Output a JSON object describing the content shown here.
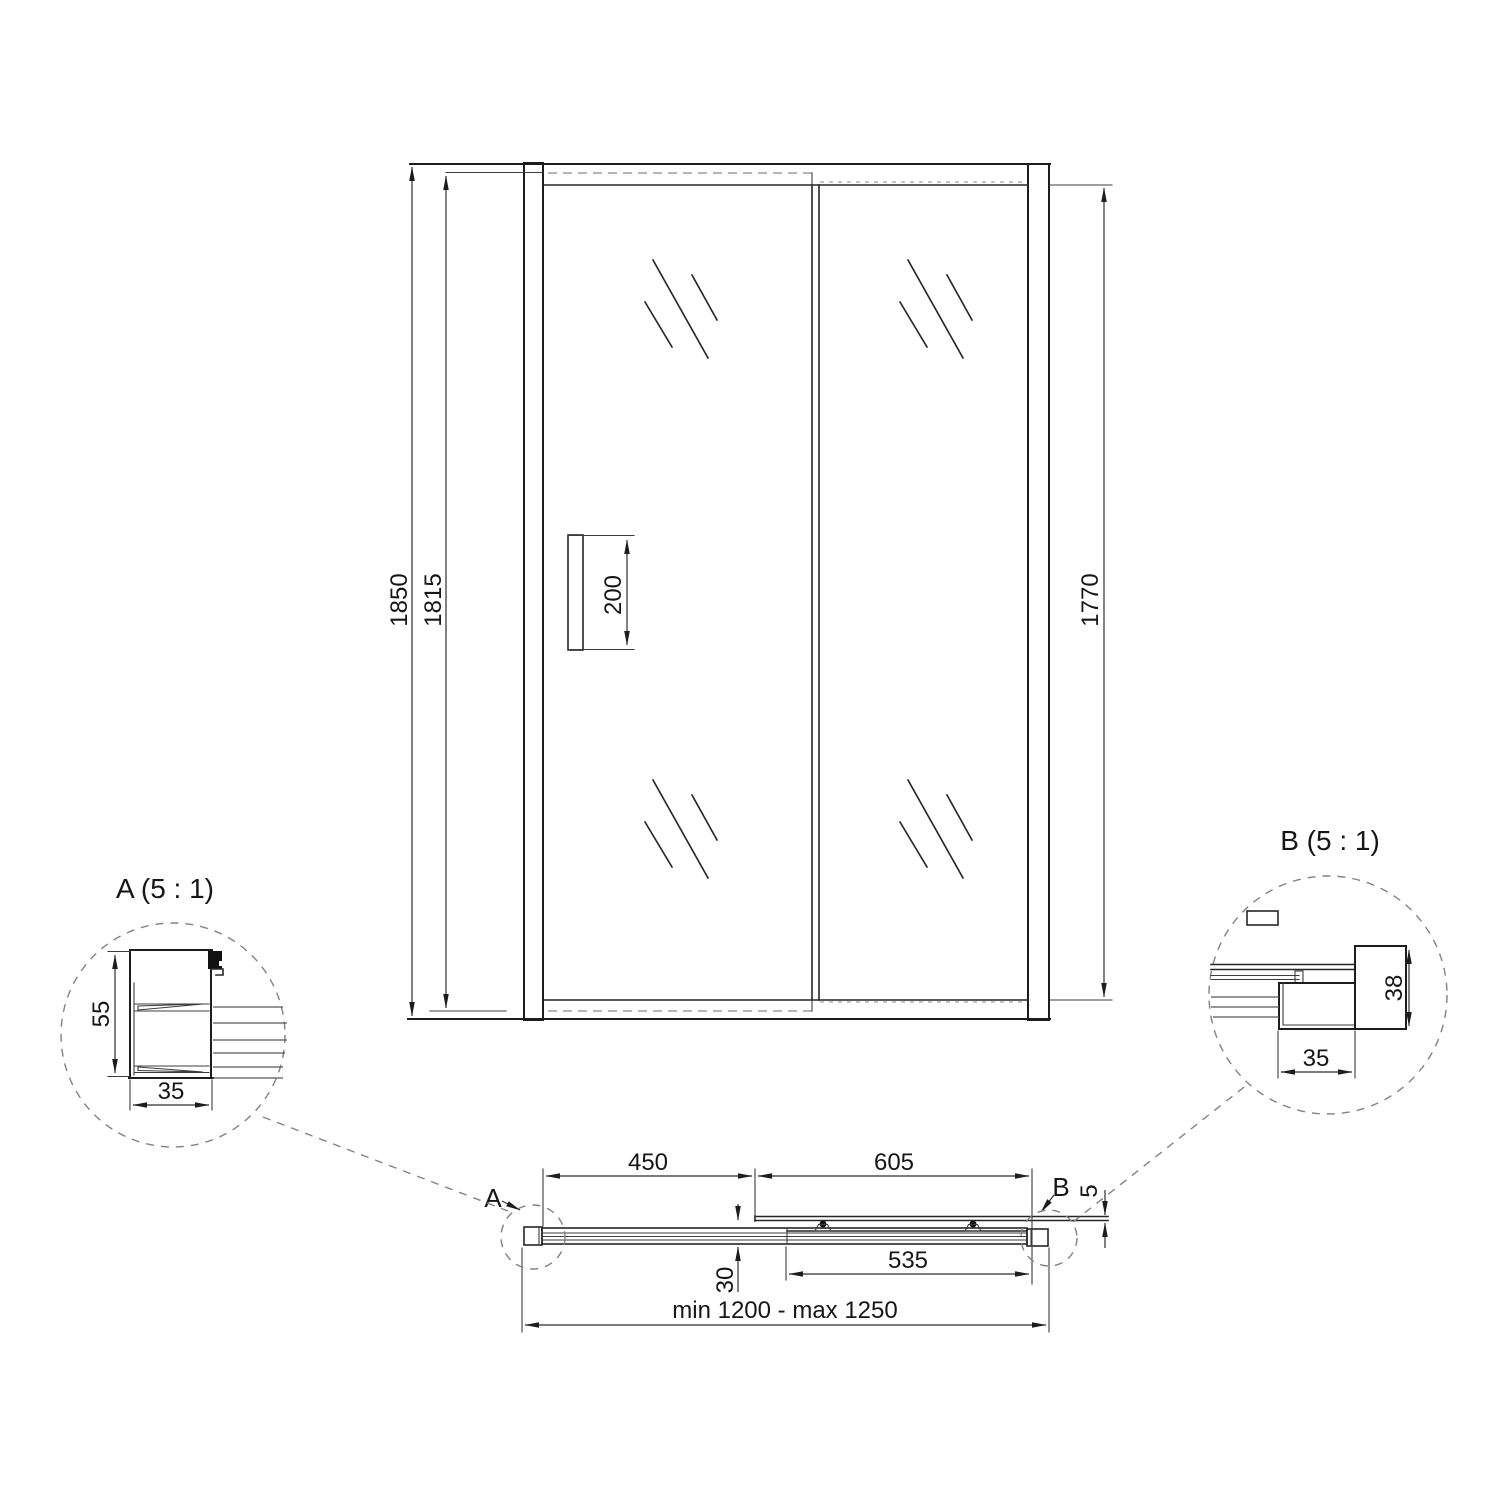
{
  "drawing": {
    "front": {
      "dim_total_height": "1850",
      "dim_door_height": "1815",
      "dim_glass_height": "1770",
      "dim_handle_height": "200"
    },
    "plan": {
      "dim_left_section": "450",
      "dim_door_panel": "605",
      "dim_overlap": "535",
      "dim_profile_depth": "30",
      "dim_glass_thickness": "5",
      "dim_width_range": "min 1200 - max 1250",
      "callout_a": "A",
      "callout_b": "B"
    },
    "detail_a": {
      "title": "A (5 : 1)",
      "dim_height": "55",
      "dim_width": "35"
    },
    "detail_b": {
      "title": "B (5 : 1)",
      "dim_height": "38",
      "dim_width": "35"
    },
    "colors": {
      "line": "#1d1d1d",
      "dashed_hidden": "#8b8b8b",
      "background": "#ffffff"
    }
  }
}
